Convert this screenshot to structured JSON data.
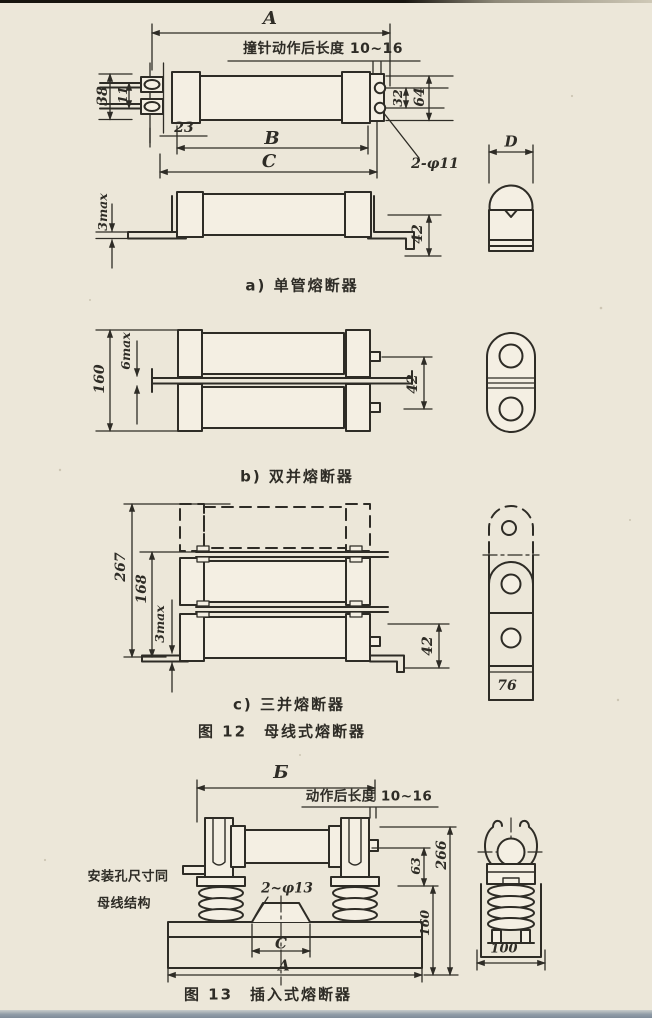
{
  "page": {
    "bg": "#ece7d9",
    "ink": "#2e2c26"
  },
  "f12a": {
    "A": "A",
    "striker": "撞针动作后长度 10~16",
    "d38": "38",
    "d11": "11",
    "d23": "23",
    "d32": "32",
    "d64": "64",
    "B": "B",
    "C": "C",
    "holes": "2-φ11",
    "max3": "3max",
    "d42": "42",
    "D": "D",
    "caption": "a) 单管熔断器"
  },
  "f12b": {
    "d160": "160",
    "max6": "6max",
    "d42": "42",
    "caption": "b) 双并熔断器"
  },
  "f12c": {
    "d267": "267",
    "d168": "168",
    "max3": "3max",
    "d42": "42",
    "d76": "76",
    "caption": "c) 三并熔断器"
  },
  "f12cap": "图 12　母线式熔断器",
  "f13": {
    "B": "Б",
    "action": "动作后长度 10~16",
    "mount1": "安装孔尺寸同",
    "mount2": "母线结构",
    "holes": "2~φ13",
    "d63": "63",
    "d266": "266",
    "d160": "160",
    "C": "C",
    "A": "A",
    "d100": "100",
    "caption": "图 13　插入式熔断器"
  }
}
